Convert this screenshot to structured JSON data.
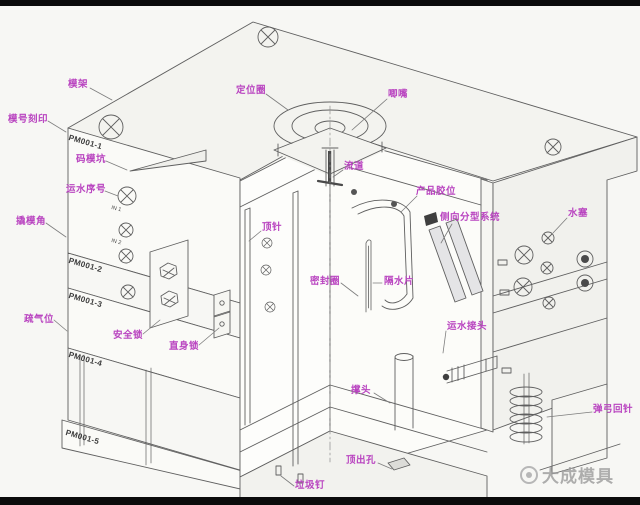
{
  "meta": {
    "background": "#f7f7f4",
    "line_color": "#5f5f5f",
    "label_color": "#b944c0",
    "watermark_color": "#9b9b9b"
  },
  "diagram": {
    "description_labels_note": "injection mold structure cutaway, Chinese part annotations",
    "part_labels": [
      {
        "text": "模架",
        "x": 68,
        "y": 80,
        "leader": [
          [
            90,
            88
          ],
          [
            112,
            100
          ]
        ]
      },
      {
        "text": "模号刻印",
        "x": 8,
        "y": 115,
        "leader": [
          [
            48,
            121
          ],
          [
            66,
            132
          ]
        ]
      },
      {
        "text": "码模坑",
        "x": 76,
        "y": 155,
        "leader": [
          [
            106,
            161
          ],
          [
            127,
            170
          ]
        ]
      },
      {
        "text": "运水序号",
        "x": 66,
        "y": 185,
        "leader": [
          [
            105,
            191
          ],
          [
            118,
            196
          ]
        ]
      },
      {
        "text": "撬模角",
        "x": 16,
        "y": 217,
        "leader": [
          [
            46,
            223
          ],
          [
            66,
            237
          ]
        ]
      },
      {
        "text": "疏气位",
        "x": 24,
        "y": 315,
        "leader": [
          [
            54,
            320
          ],
          [
            67,
            331
          ]
        ]
      },
      {
        "text": "安全锁",
        "x": 113,
        "y": 331,
        "leader": [
          [
            143,
            334
          ],
          [
            160,
            320
          ]
        ]
      },
      {
        "text": "直身锁",
        "x": 169,
        "y": 342,
        "leader": [
          [
            199,
            345
          ],
          [
            219,
            328
          ]
        ]
      },
      {
        "text": "定位圈",
        "x": 236,
        "y": 86,
        "leader": [
          [
            266,
            94
          ],
          [
            288,
            110
          ]
        ]
      },
      {
        "text": "唧嘴",
        "x": 388,
        "y": 90,
        "leader": [
          [
            387,
            99
          ],
          [
            352,
            130
          ]
        ]
      },
      {
        "text": "流道",
        "x": 344,
        "y": 162,
        "leader": [
          [
            343,
            170
          ],
          [
            333,
            177
          ]
        ]
      },
      {
        "text": "产品胶位",
        "x": 416,
        "y": 187,
        "leader": [
          [
            417,
            196
          ],
          [
            401,
            212
          ]
        ]
      },
      {
        "text": "侧向分型系统",
        "x": 440,
        "y": 213,
        "leader": [
          [
            452,
            224
          ],
          [
            441,
            243
          ]
        ]
      },
      {
        "text": "顶针",
        "x": 262,
        "y": 223,
        "leader": [
          [
            261,
            231
          ],
          [
            249,
            241
          ]
        ]
      },
      {
        "text": "密封圈",
        "x": 310,
        "y": 277,
        "leader": [
          [
            341,
            283
          ],
          [
            358,
            296
          ]
        ]
      },
      {
        "text": "隔水片",
        "x": 384,
        "y": 277,
        "leader": [
          [
            382,
            283
          ],
          [
            373,
            283
          ]
        ]
      },
      {
        "text": "水塞",
        "x": 568,
        "y": 209,
        "leader": [
          [
            567,
            218
          ],
          [
            553,
            233
          ]
        ]
      },
      {
        "text": "运水接头",
        "x": 447,
        "y": 322,
        "leader": [
          [
            446,
            331
          ],
          [
            443,
            353
          ]
        ]
      },
      {
        "text": "撑头",
        "x": 351,
        "y": 386,
        "leader": [
          [
            374,
            393
          ],
          [
            390,
            403
          ]
        ]
      },
      {
        "text": "弹弓回针",
        "x": 593,
        "y": 405,
        "leader": [
          [
            592,
            412
          ],
          [
            547,
            417
          ]
        ]
      },
      {
        "text": "顶出孔",
        "x": 346,
        "y": 456,
        "leader": [
          [
            378,
            463
          ],
          [
            392,
            469
          ]
        ]
      },
      {
        "text": "垃圾钉",
        "x": 295,
        "y": 481,
        "leader": [
          [
            294,
            486
          ],
          [
            281,
            476
          ]
        ]
      }
    ],
    "plate_marks": [
      {
        "text": "PM001-1",
        "x": 70,
        "y": 133,
        "rotate": 16
      },
      {
        "text": "PM001-2",
        "x": 70,
        "y": 256,
        "rotate": 16
      },
      {
        "text": "PM001-3",
        "x": 70,
        "y": 291,
        "rotate": 16
      },
      {
        "text": "PM001-4",
        "x": 70,
        "y": 350,
        "rotate": 16
      },
      {
        "text": "PM001-5",
        "x": 67,
        "y": 428,
        "rotate": 16
      }
    ],
    "port_marks": [
      {
        "text": "IN 1",
        "x": 112,
        "y": 205,
        "rotate": 14
      },
      {
        "text": "IN 2",
        "x": 112,
        "y": 238,
        "rotate": 14
      }
    ],
    "watermark": {
      "text": "大成模具"
    }
  }
}
